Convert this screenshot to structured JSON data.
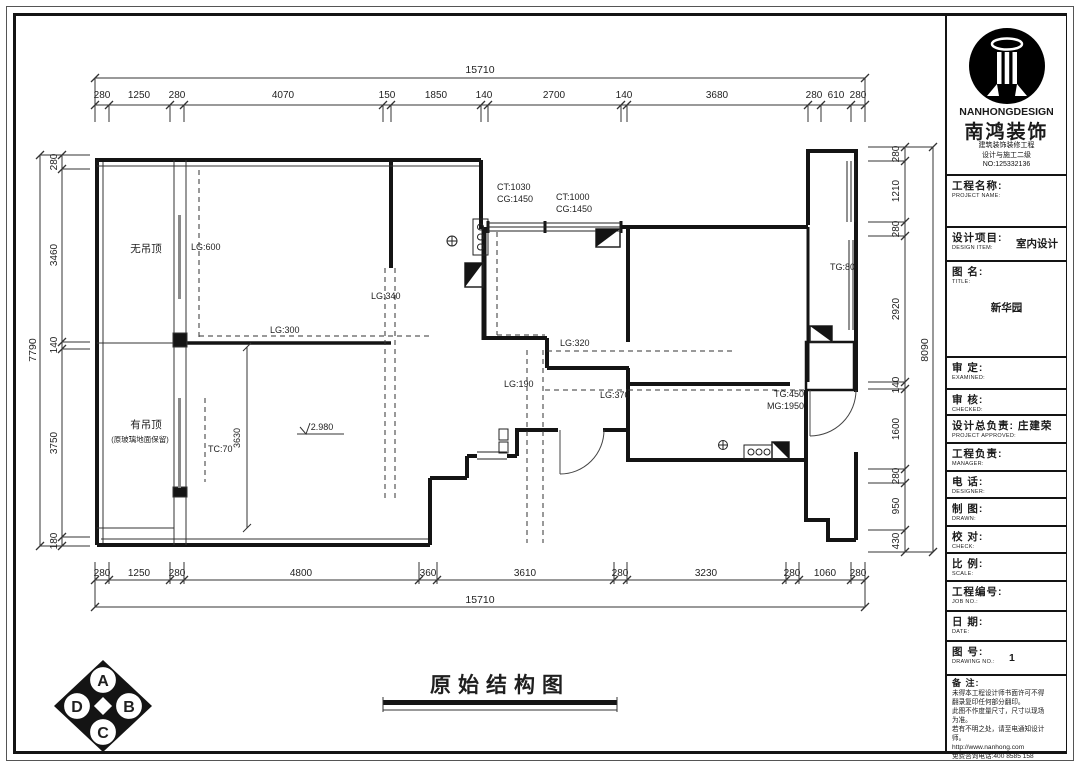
{
  "sheet": {
    "title": "原始结构图"
  },
  "brand": {
    "logo_en": "NANHONGDESIGN",
    "logo_cn": "南鸿装饰",
    "sub1": "建筑装饰装修工程",
    "sub2": "设计与施工二级",
    "sub3": "NO:125332136"
  },
  "titleblock": {
    "r_project": {
      "cn": "工程名称:",
      "en": "PROJECT NAME:",
      "value": ""
    },
    "r_design": {
      "cn": "设计项目:",
      "en": "DESIGN ITEM:",
      "value": "室内设计"
    },
    "r_title": {
      "cn": "图  名:",
      "en": "TITLE:",
      "value": "新华园"
    },
    "r_examine": {
      "cn": "审  定:",
      "en": "EXAMINED:",
      "value": ""
    },
    "r_check1": {
      "cn": "审  核:",
      "en": "CHECKED:",
      "value": ""
    },
    "r_chief": {
      "cn": "设计总负责:",
      "en": "PROJECT APPROVED:",
      "value": "庄建荣"
    },
    "r_manager": {
      "cn": "工程负责:",
      "en": "MANAGER:",
      "value": ""
    },
    "r_tel": {
      "cn": "电  话:",
      "en": "DESIGNER:",
      "value": ""
    },
    "r_drawn": {
      "cn": "制  图:",
      "en": "DRAWN:",
      "value": ""
    },
    "r_check2": {
      "cn": "校  对:",
      "en": "CHECK:",
      "value": ""
    },
    "r_scale": {
      "cn": "比  例:",
      "en": "SCALE:",
      "value": ""
    },
    "r_jobno": {
      "cn": "工程编号:",
      "en": "JOB NO.:",
      "value": ""
    },
    "r_date": {
      "cn": "日  期:",
      "en": "DATE:",
      "value": ""
    },
    "r_dno": {
      "cn": "图  号:",
      "en": "DRAWING NO.:",
      "value": "1"
    },
    "notes_title": "备 注:",
    "notes": [
      "未得本工程设计师书面许可不得",
      "翻录复印任何部分翻印。",
      "此图不作度量尺寸，尺寸以现场",
      "为准。",
      "若有不明之处，请至电通知设计",
      "师。",
      "http://www.nanhong.com",
      "免费咨询电话:400 8585 158"
    ]
  },
  "dims": {
    "top_total": "15710",
    "top": [
      "280",
      "1250",
      "280",
      "4070",
      "150",
      "1850",
      "140",
      "2700",
      "140",
      "3680",
      "280",
      "610",
      "280"
    ],
    "left_total": "7790",
    "left": [
      "280",
      "3460",
      "140",
      "3750",
      "180"
    ],
    "right_total": "8090",
    "right": [
      "280",
      "1210",
      "280",
      "2920",
      "140",
      "1600",
      "280",
      "950",
      "430"
    ],
    "bottom_total": "15710",
    "bottom": [
      "280",
      "1250",
      "280",
      "4800",
      "360",
      "3610",
      "280",
      "3230",
      "280",
      "1060",
      "280"
    ]
  },
  "labels": {
    "no_ceiling": "无吊顶",
    "has_ceiling": "有吊顶",
    "has_ceiling_note": "(原玻璃地面保留)",
    "lg600": "LG:600",
    "lg340": "LG:340",
    "lg300": "LG:300",
    "lg320": "LG:320",
    "lg190": "LG:190",
    "lg370": "LG:370",
    "tc70": "TC:70",
    "tg80": "TG:80",
    "tg450": "TG:450",
    "mg1950": "MG:1950",
    "ct1030": "CT:1030",
    "cg1450a": "CG:1450",
    "ct1000": "CT:1000",
    "cg1450b": "CG:1450",
    "dim3630": "3630",
    "level": "2.980"
  },
  "corner_logo": {
    "a": "A",
    "b": "B",
    "c": "C",
    "d": "D"
  }
}
